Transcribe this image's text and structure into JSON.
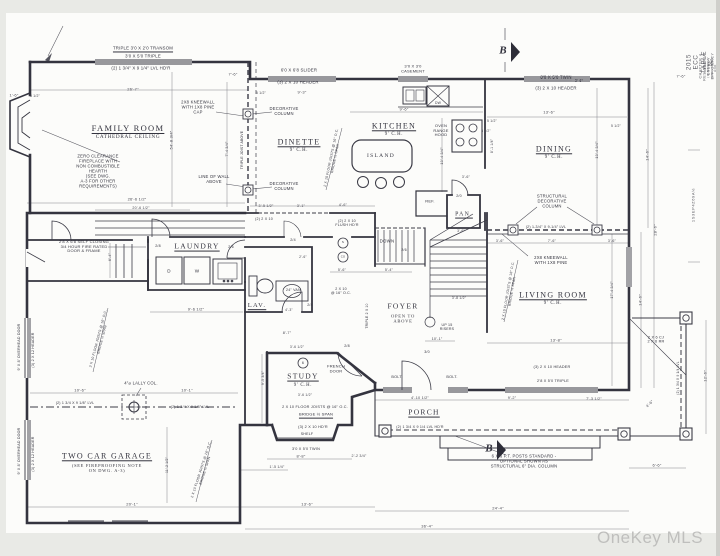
{
  "page": {
    "watermark": "OneKey MLS",
    "paper_color": "#fcfcfa",
    "margin_color": "#e9eae6",
    "ink_color": "#33333e"
  },
  "annotations": [
    {
      "t": "FAMILY ROOM",
      "x": 128,
      "y": 128,
      "k": "room",
      "u": 1,
      "n": "room-label-family-room"
    },
    {
      "t": "CATHEDRAL CEILING",
      "x": 128,
      "y": 137,
      "k": "sub",
      "s": 5.2
    },
    {
      "t": "DINETTE",
      "x": 299,
      "y": 142,
      "k": "room",
      "s": 8,
      "u": 1,
      "n": "room-label-dinette"
    },
    {
      "t": "9' C.H.",
      "x": 299,
      "y": 151,
      "k": "sub"
    },
    {
      "t": "KITCHEN",
      "x": 394,
      "y": 126,
      "k": "room",
      "s": 8,
      "u": 1,
      "n": "room-label-kitchen"
    },
    {
      "t": "9' C.H.",
      "x": 394,
      "y": 135,
      "k": "sub"
    },
    {
      "t": "DINING",
      "x": 554,
      "y": 149,
      "k": "room",
      "s": 8,
      "u": 1,
      "n": "room-label-dining"
    },
    {
      "t": "9' C.H.",
      "x": 554,
      "y": 158,
      "k": "sub"
    },
    {
      "t": "LAUNDRY",
      "x": 197,
      "y": 247,
      "k": "room",
      "s": 7.5,
      "u": 1,
      "n": "room-label-laundry"
    },
    {
      "t": "LAV.",
      "x": 257,
      "y": 306,
      "k": "room",
      "s": 6.5,
      "u": 1,
      "n": "room-label-lav"
    },
    {
      "t": "PAN.",
      "x": 464,
      "y": 215,
      "k": "room",
      "s": 5.8,
      "u": 1,
      "n": "room-label-pantry"
    },
    {
      "t": "LIVING ROOM",
      "x": 553,
      "y": 295,
      "k": "room",
      "s": 8,
      "u": 1,
      "n": "room-label-living-room"
    },
    {
      "t": "9' C.H.",
      "x": 553,
      "y": 304,
      "k": "sub"
    },
    {
      "t": "FOYER",
      "x": 403,
      "y": 307,
      "k": "room",
      "s": 7.5,
      "n": "room-label-foyer"
    },
    {
      "t": "OPEN TO\nABOVE",
      "x": 403,
      "y": 319,
      "k": "sub",
      "s": 4.6
    },
    {
      "t": "STUDY",
      "x": 303,
      "y": 377,
      "k": "room",
      "s": 7.5,
      "u": 1,
      "n": "room-label-study"
    },
    {
      "t": "9' C.H.",
      "x": 303,
      "y": 386,
      "k": "sub"
    },
    {
      "t": "PORCH",
      "x": 424,
      "y": 413,
      "k": "room",
      "s": 7.5,
      "u": 1,
      "n": "room-label-porch"
    },
    {
      "t": "TWO CAR GARAGE",
      "x": 107,
      "y": 456,
      "k": "room",
      "s": 8,
      "u": 1,
      "n": "room-label-garage"
    },
    {
      "t": "(SEE FIREPROOFING NOTE\nON DWG. A-3)",
      "x": 107,
      "y": 468,
      "k": "sub",
      "s": 4.4
    },
    {
      "t": "ISLAND",
      "x": 381,
      "y": 156,
      "k": "room",
      "s": 5.5,
      "n": "island-label"
    },
    {
      "t": "REF.",
      "x": 430,
      "y": 202,
      "k": "note",
      "s": 4,
      "n": "fridge-label"
    },
    {
      "t": "DOWN",
      "x": 387,
      "y": 241,
      "k": "note",
      "s": 4.4,
      "n": "stairs-down-label"
    },
    {
      "t": "UP 15\nRISERS",
      "x": 447,
      "y": 327,
      "k": "note",
      "s": 3.6,
      "n": "stairs-up-label"
    },
    {
      "t": "OVEN\nRANGE\nHOOD",
      "x": 441,
      "y": 131,
      "k": "note",
      "s": 4,
      "n": "range-label"
    },
    {
      "t": "D",
      "x": 169,
      "y": 271,
      "k": "note",
      "s": 4.6,
      "n": "dryer-label"
    },
    {
      "t": "W",
      "x": 197,
      "y": 271,
      "k": "note",
      "s": 4.6,
      "n": "washer-label"
    },
    {
      "t": "DW",
      "x": 438,
      "y": 103,
      "k": "note",
      "s": 3.4,
      "n": "dishwasher-label"
    },
    {
      "t": "S",
      "x": 343,
      "y": 243,
      "k": "note",
      "s": 3,
      "n": "smoke-detector-label"
    },
    {
      "t": "CO",
      "x": 343,
      "y": 257,
      "k": "note",
      "s": 2.8,
      "n": "co-detector-label"
    },
    {
      "t": "6",
      "x": 303,
      "y": 363,
      "k": "note",
      "s": 3.6,
      "n": "keynote-6"
    },
    {
      "t": "TRIPLE 3'0 X 2'0 TRANSOM",
      "x": 143,
      "y": 48,
      "k": "note",
      "u": 1
    },
    {
      "t": "3'0 X 5'0 TRIPLE",
      "x": 143,
      "y": 56,
      "k": "note"
    },
    {
      "t": "(2) 1 3/4\" X 9 1/4\" LVL HD'R",
      "x": 141,
      "y": 68,
      "k": "note"
    },
    {
      "t": "6'0 X 6'8 SLIDER",
      "x": 299,
      "y": 70,
      "k": "note"
    },
    {
      "t": "(3) 2 X 10 HEADER",
      "x": 298,
      "y": 82,
      "k": "note"
    },
    {
      "t": "3'0 X 3'0\nCASEMENT",
      "x": 413,
      "y": 69,
      "k": "note",
      "s": 4
    },
    {
      "t": "3'0 X 5'0 TWIN",
      "x": 556,
      "y": 77,
      "k": "note",
      "u": 1
    },
    {
      "t": "(3) 2 X 10 HEADER",
      "x": 556,
      "y": 88,
      "k": "note"
    },
    {
      "t": "ZERO CLEARANCE\nFIREPLACE WITH\nNON COMBUSTIBLE\nHEARTH\n(SEE DWG.\nA-3 FOR OTHER\nREQUIREMENTS)",
      "x": 98,
      "y": 172,
      "k": "note",
      "s": 4.2,
      "n": "fireplace-note"
    },
    {
      "t": "2X8 KNEEWALL\nWITH 1X8 PINE\nCAP",
      "x": 198,
      "y": 108,
      "k": "note",
      "s": 4.2
    },
    {
      "t": "LINE OF WALL\nABOVE",
      "x": 214,
      "y": 180,
      "k": "note",
      "s": 4.2
    },
    {
      "t": "DECORATIVE\nCOLUMN",
      "x": 284,
      "y": 112,
      "k": "note",
      "s": 4.2
    },
    {
      "t": "DECORATIVE\nCOLUMN",
      "x": 284,
      "y": 187,
      "k": "note",
      "s": 4.2
    },
    {
      "t": "STRUCTURAL\nDECORATIVE\nCOLUMN",
      "x": 552,
      "y": 202,
      "k": "note",
      "s": 4.2
    },
    {
      "t": "(2) 1-3/4\" X 9-1/4\" LVL",
      "x": 546,
      "y": 227,
      "k": "note",
      "s": 3.6
    },
    {
      "t": "2X8 KNEEWALL\nWITH 1X8 PINE",
      "x": 551,
      "y": 261,
      "k": "note",
      "s": 4.2
    },
    {
      "t": "2'8 X 6'8 SELF CLOSING\n3/4 HOUR FIRE RATED\nDOOR & FRAME",
      "x": 84,
      "y": 247,
      "k": "note",
      "s": 4
    },
    {
      "t": "4\"⌀ LALLY COL.",
      "x": 141,
      "y": 384,
      "k": "note",
      "s": 4.2,
      "n": "lally-column-label"
    },
    {
      "t": "(2) 1 3/4 X 9 1/8\" LVL",
      "x": 75,
      "y": 403,
      "k": "note",
      "s": 3.6
    },
    {
      "t": "(2) 1 3/4 X 9 1/8\" LVL",
      "x": 190,
      "y": 407,
      "k": "note",
      "s": 3.6
    },
    {
      "t": "(2) 1 3/4 X 9 1/4 LVL HD'R",
      "x": 420,
      "y": 427,
      "k": "note",
      "s": 3.6
    },
    {
      "t": "(3) 2 X 10 HD'R",
      "x": 313,
      "y": 427,
      "k": "note",
      "s": 3.8
    },
    {
      "t": "SHELF",
      "x": 307,
      "y": 434,
      "k": "note",
      "s": 3.6
    },
    {
      "t": "3'0 X 5'0 TWIN",
      "x": 306,
      "y": 449,
      "k": "note",
      "s": 3.8
    },
    {
      "t": "(3) 2 X 10 HEADER",
      "x": 552,
      "y": 367,
      "k": "note",
      "s": 3.8
    },
    {
      "t": "2'8 X 5'0 TRIPLE",
      "x": 553,
      "y": 381,
      "k": "note",
      "s": 3.8
    },
    {
      "t": "FRENCH\nDOOR",
      "x": 336,
      "y": 369,
      "k": "note",
      "s": 4,
      "n": "french-door-label"
    },
    {
      "t": "6 X 6 P.T. POSTS STANDARD -\nOPTIONAL SHOWN AS\nSTRUCTURAL 6\" DIA. COLUMN",
      "x": 524,
      "y": 462,
      "k": "note",
      "s": 4.2
    },
    {
      "t": "2 X 6 CJ\n2 X 6 RR",
      "x": 656,
      "y": 340,
      "k": "note",
      "s": 3.8
    },
    {
      "t": "(2) 2 X 10",
      "x": 264,
      "y": 219,
      "k": "note",
      "s": 3.6
    },
    {
      "t": "(2) 2 X 10\nFLUSH HD'R",
      "x": 347,
      "y": 223,
      "k": "note",
      "s": 3.6
    },
    {
      "t": "2 X 10\n@ 16\" O.C.",
      "x": 341,
      "y": 291,
      "k": "note",
      "s": 3.6
    },
    {
      "t": "24\" VAN.",
      "x": 294,
      "y": 290,
      "k": "note",
      "s": 3.6,
      "n": "vanity-label"
    },
    {
      "t": "BOLT.",
      "x": 397,
      "y": 377,
      "k": "note",
      "s": 3.8
    },
    {
      "t": "BOLT.",
      "x": 452,
      "y": 377,
      "k": "note",
      "s": 3.8
    },
    {
      "t": "2 X 10 FLOOR JOISTS @ 16\" O.C.",
      "x": 315,
      "y": 407,
      "k": "note",
      "s": 3.8
    },
    {
      "t": "BRIDGE ½ SPAN",
      "x": 316,
      "y": 415,
      "k": "note",
      "s": 4,
      "u": 1
    },
    {
      "t": "2 X 10 FLOOR JOISTS @ 16\" O.C.\nBRIDGE ½ SPAN",
      "x": 333,
      "y": 158,
      "k": "note",
      "s": 3.4,
      "r": -78
    },
    {
      "t": "2 X 10 FLOOR JOISTS @ 16\" O.C.\nBRIDGE ½ SPAN",
      "x": 510,
      "y": 291,
      "k": "note",
      "s": 3.4,
      "r": -80
    },
    {
      "t": "2 X 10 FLOOR JOISTS @ 16\" O.C.\nBRIDGE ½ SPAN",
      "x": 203,
      "y": 470,
      "k": "note",
      "s": 3.4,
      "r": -72
    },
    {
      "t": "2 X 10 FLOOR JOISTS @ 16\" O.C.\nBRIDGE ½ SPAN",
      "x": 100,
      "y": 339,
      "k": "note",
      "s": 3.4,
      "r": -75
    },
    {
      "t": "TRIPLE JOIST ABOVE",
      "x": 242,
      "y": 150,
      "k": "note",
      "s": 3.4,
      "r": -90
    },
    {
      "t": "TRIPLE 2 X 10",
      "x": 367,
      "y": 316,
      "k": "note",
      "s": 3.4,
      "r": -90
    },
    {
      "t": "9' X 8' OVERHEAD DOOR",
      "x": 19,
      "y": 347,
      "k": "note",
      "s": 3.6,
      "r": -90,
      "n": "overhead-door-label"
    },
    {
      "t": "(3) 2 X 12 HEADER",
      "x": 33,
      "y": 350,
      "k": "note",
      "s": 3.6,
      "r": -90
    },
    {
      "t": "9' X 8' OVERHEAD DOOR",
      "x": 19,
      "y": 451,
      "k": "note",
      "s": 3.6,
      "r": -90,
      "n": "overhead-door-label"
    },
    {
      "t": "(3) 2 X 12 HEADER",
      "x": 33,
      "y": 454,
      "k": "note",
      "s": 3.6,
      "r": -90
    },
    {
      "t": "2/6",
      "x": 231,
      "y": 247,
      "k": "note",
      "s": 3.6,
      "n": "door-size-tag"
    },
    {
      "t": "2/4",
      "x": 293,
      "y": 240,
      "k": "note",
      "s": 3.6,
      "n": "door-size-tag"
    },
    {
      "t": "2/4",
      "x": 310,
      "y": 305,
      "k": "note",
      "s": 3.6,
      "n": "door-size-tag"
    },
    {
      "t": "2/8",
      "x": 347,
      "y": 346,
      "k": "note",
      "s": 3.6,
      "n": "door-size-tag"
    },
    {
      "t": "2/0",
      "x": 459,
      "y": 196,
      "k": "note",
      "s": 3.6,
      "n": "door-size-tag"
    },
    {
      "t": "3/0",
      "x": 427,
      "y": 352,
      "k": "note",
      "s": 3.6,
      "n": "door-size-tag"
    },
    {
      "t": "2/6",
      "x": 404,
      "y": 250,
      "k": "note",
      "s": 3.6,
      "n": "door-size-tag"
    },
    {
      "t": "2/8",
      "x": 158,
      "y": 246,
      "k": "note",
      "s": 3.6,
      "n": "door-size-tag"
    },
    {
      "t": "26'-7\"",
      "x": 133,
      "y": 90,
      "k": "dim"
    },
    {
      "t": "1'-6\"",
      "x": 14,
      "y": 96,
      "k": "dim"
    },
    {
      "t": "5 1/2\"",
      "x": 35,
      "y": 96,
      "k": "dim",
      "s": 3.4
    },
    {
      "t": "7'-6\"",
      "x": 233,
      "y": 75,
      "k": "dim"
    },
    {
      "t": "5 1/2\"",
      "x": 261,
      "y": 93,
      "k": "dim",
      "s": 3.4
    },
    {
      "t": "9'-3\"",
      "x": 302,
      "y": 93,
      "k": "dim"
    },
    {
      "t": "9'-6\"",
      "x": 404,
      "y": 110,
      "k": "dim"
    },
    {
      "t": "13'-6\"",
      "x": 549,
      "y": 113,
      "k": "dim"
    },
    {
      "t": "5 1/2\"",
      "x": 492,
      "y": 121,
      "k": "dim",
      "s": 3.4
    },
    {
      "t": "5 1/2\"",
      "x": 616,
      "y": 126,
      "k": "dim",
      "s": 3.4
    },
    {
      "t": "3'-6\"",
      "x": 579,
      "y": 81,
      "k": "dim",
      "s": 3.6
    },
    {
      "t": "7'-6\"",
      "x": 681,
      "y": 77,
      "k": "dim"
    },
    {
      "t": "54'-8 3/4\"",
      "x": 172,
      "y": 140,
      "k": "dim",
      "r": -90
    },
    {
      "t": "7'-4 3/4\"",
      "x": 227,
      "y": 149,
      "k": "dim",
      "r": -90,
      "s": 3.6
    },
    {
      "t": "13'-4 3/4\"",
      "x": 442,
      "y": 156,
      "k": "dim",
      "r": -90,
      "s": 3.6
    },
    {
      "t": "8'-1 1/4\"",
      "x": 492,
      "y": 146,
      "k": "dim",
      "r": -90,
      "s": 3.4
    },
    {
      "t": "3 1/2\"",
      "x": 486,
      "y": 132,
      "k": "dim",
      "s": 3.2
    },
    {
      "t": "3'-6\"",
      "x": 466,
      "y": 177,
      "k": "dim",
      "s": 3.6
    },
    {
      "t": "13'-4 3/4\"",
      "x": 597,
      "y": 150,
      "k": "dim",
      "r": -90,
      "s": 3.6
    },
    {
      "t": "14'-6\"",
      "x": 648,
      "y": 155,
      "k": "dim",
      "r": -90
    },
    {
      "t": "28'-6\"",
      "x": 656,
      "y": 230,
      "k": "dim",
      "r": -90
    },
    {
      "t": "14'-6\"",
      "x": 641,
      "y": 300,
      "k": "dim",
      "r": -90
    },
    {
      "t": "17'-4 3/4\"",
      "x": 612,
      "y": 290,
      "k": "dim",
      "r": -90,
      "s": 3.6
    },
    {
      "t": "12'-6\"",
      "x": 706,
      "y": 376,
      "k": "dim",
      "r": -90
    },
    {
      "t": "(2) 1 3/4 X 9 1/4 LVL",
      "x": 679,
      "y": 378,
      "k": "note",
      "s": 3.2,
      "r": -90
    },
    {
      "t": "4'-6\"",
      "x": 650,
      "y": 404,
      "k": "dim",
      "r": -45,
      "s": 3.8
    },
    {
      "t": "6'-6\"",
      "x": 657,
      "y": 466,
      "k": "dim"
    },
    {
      "t": "24'-4\"",
      "x": 498,
      "y": 509,
      "k": "dim"
    },
    {
      "t": "36'-4\"",
      "x": 427,
      "y": 527,
      "k": "dim"
    },
    {
      "t": "13'-8\"",
      "x": 556,
      "y": 341,
      "k": "dim"
    },
    {
      "t": "3'-6\"",
      "x": 500,
      "y": 241,
      "k": "dim",
      "s": 3.6
    },
    {
      "t": "7'-6\"",
      "x": 552,
      "y": 241,
      "k": "dim",
      "s": 3.6
    },
    {
      "t": "3'-6\"",
      "x": 612,
      "y": 241,
      "k": "dim",
      "s": 3.6
    },
    {
      "t": "26'-6 1/2\"",
      "x": 137,
      "y": 200,
      "k": "dim"
    },
    {
      "t": "20'-6 1/2\"",
      "x": 141,
      "y": 208,
      "k": "dim",
      "s": 3.6
    },
    {
      "t": "3'-5 1/2\"",
      "x": 266,
      "y": 206,
      "k": "dim",
      "s": 3.6
    },
    {
      "t": "3'-1\"",
      "x": 301,
      "y": 206,
      "k": "dim",
      "s": 3.6
    },
    {
      "t": "4'-6\"",
      "x": 343,
      "y": 205,
      "k": "dim",
      "s": 3.6
    },
    {
      "t": "5'-6\"",
      "x": 342,
      "y": 270,
      "k": "dim",
      "s": 3.6
    },
    {
      "t": "5'-4\"",
      "x": 389,
      "y": 270,
      "k": "dim",
      "s": 3.6
    },
    {
      "t": "9'-6 1/2\"",
      "x": 196,
      "y": 310,
      "k": "dim"
    },
    {
      "t": "6'-4\"",
      "x": 110,
      "y": 257,
      "k": "dim",
      "r": -90,
      "s": 3.6
    },
    {
      "t": "2'-6\"",
      "x": 303,
      "y": 257,
      "k": "dim",
      "s": 3.4
    },
    {
      "t": "4'-3\"",
      "x": 289,
      "y": 310,
      "k": "dim",
      "s": 3.4
    },
    {
      "t": "8'-7\"",
      "x": 287,
      "y": 333,
      "k": "dim",
      "s": 3.8
    },
    {
      "t": "3'-6 1/2\"",
      "x": 297,
      "y": 347,
      "k": "dim",
      "s": 3.4
    },
    {
      "t": "3'-6 1/2\"",
      "x": 305,
      "y": 395,
      "k": "dim",
      "s": 3.4
    },
    {
      "t": "9'-5 3/4\"",
      "x": 263,
      "y": 378,
      "k": "dim",
      "r": -90,
      "s": 3.4
    },
    {
      "t": "8'-8\"",
      "x": 301,
      "y": 457,
      "k": "dim"
    },
    {
      "t": "2'-2 3/4\"",
      "x": 359,
      "y": 456,
      "k": "dim",
      "s": 3.6
    },
    {
      "t": "1'-5 1/4\"",
      "x": 277,
      "y": 467,
      "k": "dim",
      "s": 3.6
    },
    {
      "t": "13'-6\"",
      "x": 307,
      "y": 505,
      "k": "dim"
    },
    {
      "t": "10'-6\"",
      "x": 80,
      "y": 391,
      "k": "dim"
    },
    {
      "t": "10'-1\"",
      "x": 187,
      "y": 391,
      "k": "dim"
    },
    {
      "t": "20'-1\"",
      "x": 132,
      "y": 505,
      "k": "dim"
    },
    {
      "t": "11'-2 1/2\"",
      "x": 167,
      "y": 465,
      "k": "dim",
      "r": -90,
      "s": 3.4
    },
    {
      "t": "4'-10 1/2\"",
      "x": 420,
      "y": 398,
      "k": "dim",
      "s": 3.8
    },
    {
      "t": "9'-2\"",
      "x": 512,
      "y": 398,
      "k": "dim",
      "s": 3.8
    },
    {
      "t": "7'-3 1/2\"",
      "x": 594,
      "y": 399,
      "k": "dim",
      "s": 3.8
    },
    {
      "t": "10'-1\"",
      "x": 437,
      "y": 339,
      "k": "dim",
      "s": 3.8
    },
    {
      "t": "3'-8 1/2\"",
      "x": 459,
      "y": 298,
      "k": "dim",
      "s": 3.4
    },
    {
      "t": "3'-6\"",
      "x": 461,
      "y": 231,
      "k": "dim",
      "s": 3.4
    },
    {
      "t": "B",
      "x": 503,
      "y": 51,
      "k": "marker",
      "n": "section-marker-b-top"
    },
    {
      "t": "B",
      "x": 489,
      "y": 449,
      "k": "marker",
      "n": "section-marker-b-bottom"
    },
    {
      "t": "2015 ECC TABLE N-",
      "x": 700,
      "y": 62,
      "k": "margin",
      "r": -90,
      "s": 6.2,
      "n": "margin-title"
    },
    {
      "t": "CHAPTER 4 RESIDENTIAL ENERGY EFFICIENCY - SECTION",
      "x": 709,
      "y": 66,
      "k": "margin",
      "r": -90,
      "s": 3.5,
      "n": "margin-subtitle"
    },
    {
      "t": "TABLE (R)402.1.2 INSULATION AND FENESTRATION REQUIREMENTS",
      "x": 714,
      "y": 68,
      "k": "margin",
      "r": -90,
      "s": 2.8,
      "n": "margin-table-ref"
    },
    {
      "t": "1S3EP4Z69A½",
      "x": 694,
      "y": 205,
      "k": "margin",
      "r": -90,
      "s": 4,
      "n": "margin-edge-text"
    }
  ]
}
